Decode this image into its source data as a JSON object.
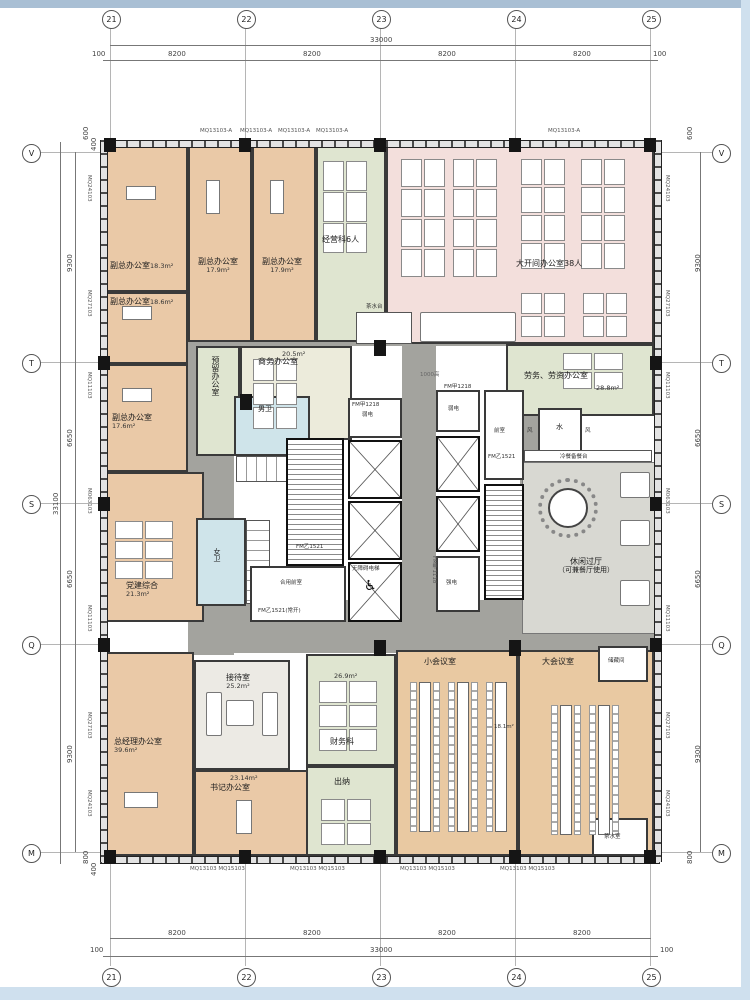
{
  "ruler": {
    "top": {
      "bubbles": [
        "21",
        "22",
        "23",
        "24",
        "25"
      ],
      "total": "33000",
      "seg": "8200",
      "edge": "100"
    },
    "bottom": {
      "bubbles": [
        "21",
        "22",
        "23",
        "24",
        "25"
      ],
      "total": "33000",
      "seg": "8200",
      "edge": "100"
    },
    "left": {
      "bubbles": [
        "V",
        "T",
        "S",
        "Q",
        "M"
      ],
      "segs": [
        "9300",
        "6650",
        "6650",
        "9300"
      ],
      "total": "33100",
      "off_top": [
        "600",
        "400"
      ],
      "off_bottom": [
        "800",
        "400"
      ]
    },
    "right": {
      "bubbles": [
        "V",
        "T",
        "S",
        "Q",
        "M"
      ],
      "segs": [
        "9300",
        "6650",
        "6650",
        "9300"
      ],
      "off_top": [
        "600",
        "400"
      ],
      "off_bottom": [
        "800",
        "400"
      ]
    }
  },
  "facade": {
    "left": [
      "MQ24103",
      "MQ27103",
      "MQ11103",
      "M063103",
      "MQ11103",
      "MQ27103",
      "MQ24103"
    ],
    "right": [
      "MQ24103",
      "MQ27103",
      "MQ11103",
      "M063103",
      "MQ11103",
      "MQ27103",
      "MQ24103"
    ],
    "top": "MQ13103-A",
    "bottom_pair": "MQ13103 MQ15103"
  },
  "rooms": [
    {
      "label": "副总办公室",
      "area": "18.3m²"
    },
    {
      "label": "副总办公室",
      "area": "17.9m²"
    },
    {
      "label": "副总办公室",
      "area": "17.9m²"
    },
    {
      "label": "经营科6人",
      "area": ""
    },
    {
      "label": "大开间办公室38人",
      "area": ""
    },
    {
      "label": "副总办公室",
      "area": "18.6m²"
    },
    {
      "label": "副总办公室",
      "area": "17.6m²"
    },
    {
      "label": "预留办公室",
      "area": ""
    },
    {
      "label": "商务办公室",
      "area": "20.5m²"
    },
    {
      "label": "劳务、劳资办公室",
      "area": "28.8m²"
    },
    {
      "label": "党建综合",
      "area": "21.3m²"
    },
    {
      "label": "休闲过厅",
      "note": "（可兼餐厅使用）"
    },
    {
      "label": "总经理办公室",
      "area": "39.6m²"
    },
    {
      "label": "接待室",
      "area": "25.2m²"
    },
    {
      "label": "书记办公室",
      "area": "23.14m²"
    },
    {
      "label": "财务科",
      "area": "26.9m²"
    },
    {
      "label": "出纳",
      "area": ""
    },
    {
      "label": "小会议室",
      "area": "18.1m²"
    },
    {
      "label": "大会议室",
      "area": ""
    },
    {
      "label": "储藏间",
      "area": ""
    },
    {
      "label": "茶水室",
      "area": ""
    }
  ],
  "core": {
    "men_wc": "男卫",
    "women_wc": "女卫",
    "front": "前室",
    "shared_front": "合用前室",
    "acc_elev": "无障碍电梯",
    "weak": "弱电",
    "strong": "强电",
    "water": "水",
    "vent": "风",
    "tea": "茶水台",
    "buffet": "冷餐备餐台",
    "h1000": "1000高"
  },
  "doors": {
    "a": "FM乙1521",
    "a_open": "FM乙1521(常开)",
    "b": "FM甲1218",
    "c": "FM甲1118"
  }
}
